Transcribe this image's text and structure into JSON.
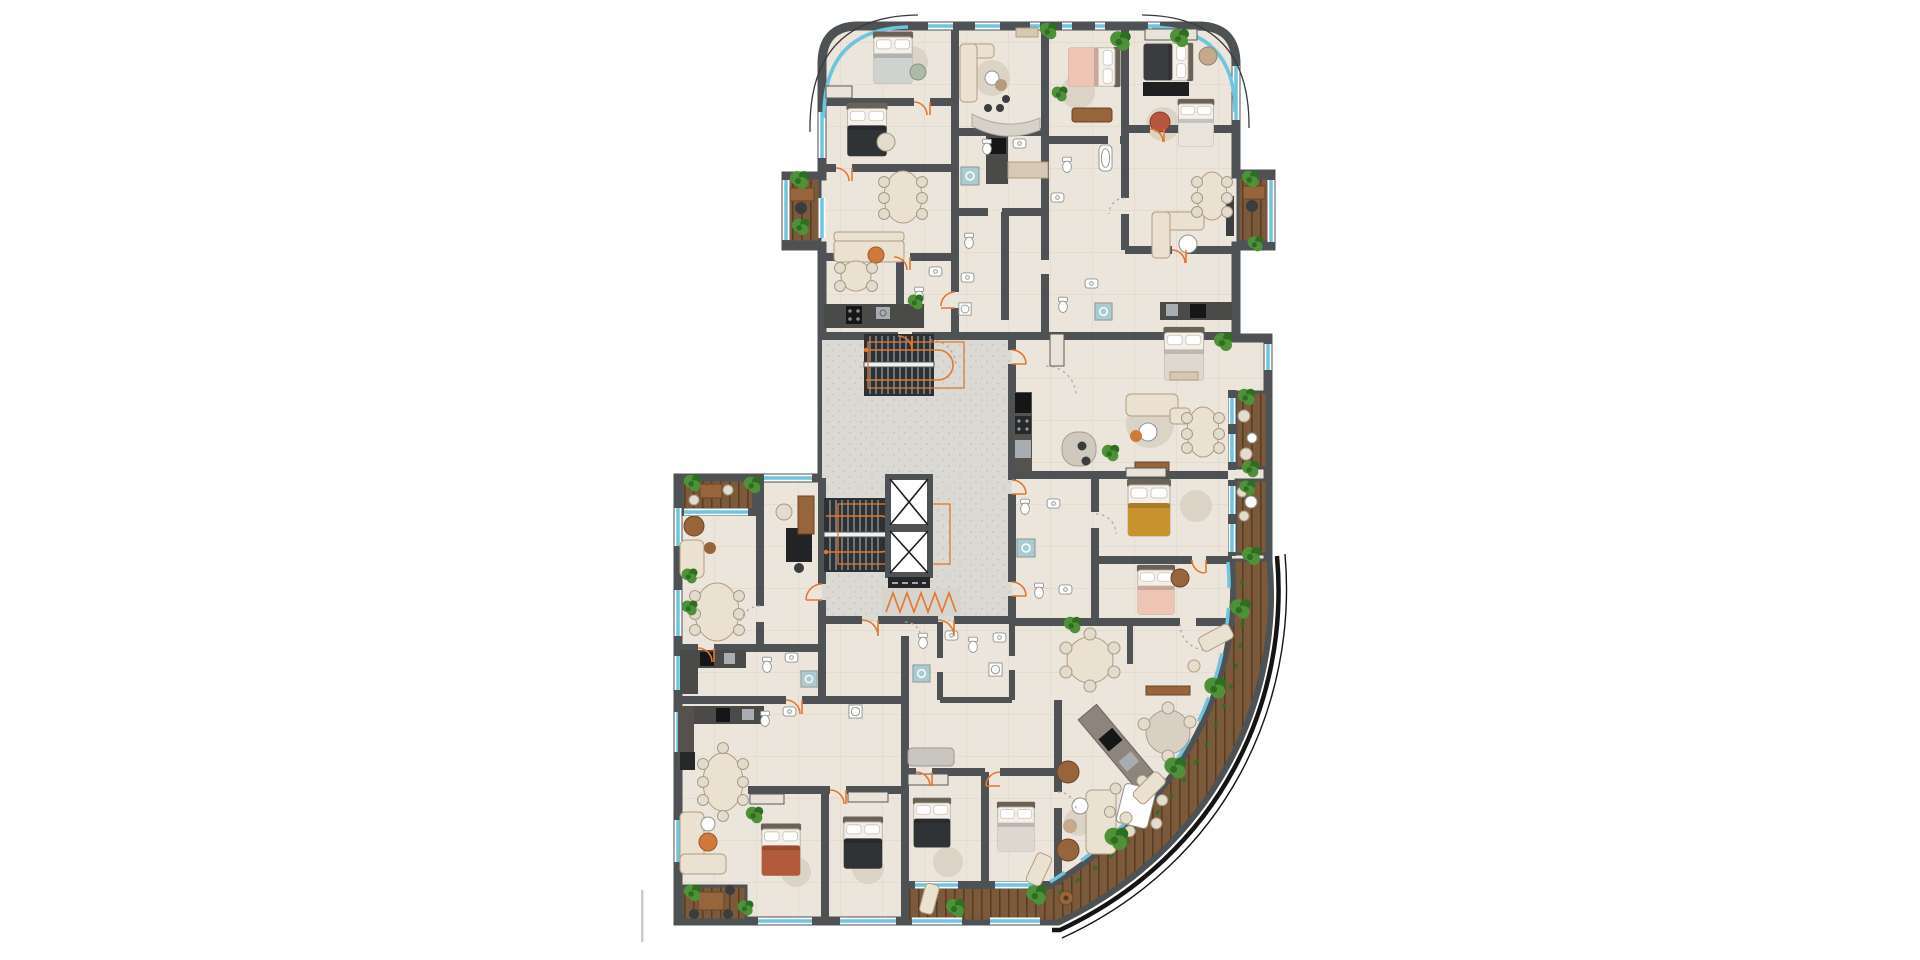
{
  "page": {
    "background": "#ffffff",
    "content_kind": "architectural floor plan, top-down render, no labels"
  },
  "palette": {
    "bg": "#ffffff",
    "wall": "#4e5255",
    "wallDark": "#2c2f31",
    "dark": "#2e3133",
    "floor": "#ece5db",
    "floorLine": "#ded4c6",
    "corridor": "#dbd9d3",
    "corridorDot": "#c2bfb8",
    "deck": "#7b5a3c",
    "deckLine": "#56381f",
    "glass": "#6fc4de",
    "accent": "#e2782f",
    "plant1": "#4f9138",
    "plant2": "#2e6e22",
    "counter": "#4a4a48",
    "steel": "#a7adb0",
    "cream": "#eae1d1",
    "beige": "#d6c9b4",
    "tan": "#b39c7e",
    "brown": "#96653c",
    "pink": "#eec5b5",
    "mustard": "#c8922f",
    "rust": "#b25a3a",
    "graySheet": "#cfd3cf",
    "rugc": "#d9d0c3",
    "fixLine": "#90938f",
    "shower": "#a8ccd1",
    "outline": "#191a1b",
    "scalebar": "#cccccc"
  },
  "floorplan": {
    "title": "Residential tower typical storey plan",
    "view": "top-down floor plan",
    "core": {
      "staircases": 2,
      "elevator_shafts": 2,
      "corridor": true,
      "entry_mat_zigzag": true
    },
    "apartments": [
      {
        "id": "top-left",
        "rooms": [
          "bedroom",
          "bedroom",
          "dining",
          "living",
          "kitchen",
          "bathroom",
          "side-balcony"
        ]
      },
      {
        "id": "top-middle",
        "rooms": [
          "living",
          "breakfast-bar",
          "bedroom-pink",
          "bathrooms"
        ]
      },
      {
        "id": "top-right",
        "rooms": [
          "bedroom",
          "bedroom",
          "dining",
          "living",
          "kitchen",
          "side-balcony"
        ]
      },
      {
        "id": "middle-right",
        "rooms": [
          "entry",
          "kitchen",
          "living-dining",
          "bedroom",
          "bedroom-mustard",
          "bedroom-pink",
          "bathrooms",
          "balconies"
        ]
      },
      {
        "id": "lower-left",
        "rooms": [
          "planted-balcony",
          "living",
          "study",
          "dining",
          "kitchen",
          "bathroom"
        ]
      },
      {
        "id": "bottom-left",
        "rooms": [
          "kitchen",
          "dining",
          "living",
          "bedroom-rust",
          "bedroom-dark",
          "deck-balcony"
        ]
      },
      {
        "id": "bottom-middle",
        "rooms": [
          "bathrooms",
          "bedroom",
          "bedroom",
          "lounge"
        ]
      },
      {
        "id": "bottom-right",
        "rooms": [
          "dining-round",
          "diagonal-kitchen",
          "living",
          "curved-terrace"
        ]
      }
    ],
    "balconies": {
      "wood_deck_count": 7,
      "curved_corner_terrace": true,
      "planters": true,
      "loungers": 4
    },
    "furniture_counts": {
      "beds": 12,
      "sofas": 8,
      "dining_tables": 9,
      "plants": 27,
      "bath_fixtures": 24
    },
    "annotations": {
      "door_swings": "orange quarter arcs",
      "open_passages": "gray dashed arcs",
      "escape_route": "orange line over stair flights",
      "entry_mat": "orange zigzag",
      "scale_marker_line": true
    }
  }
}
